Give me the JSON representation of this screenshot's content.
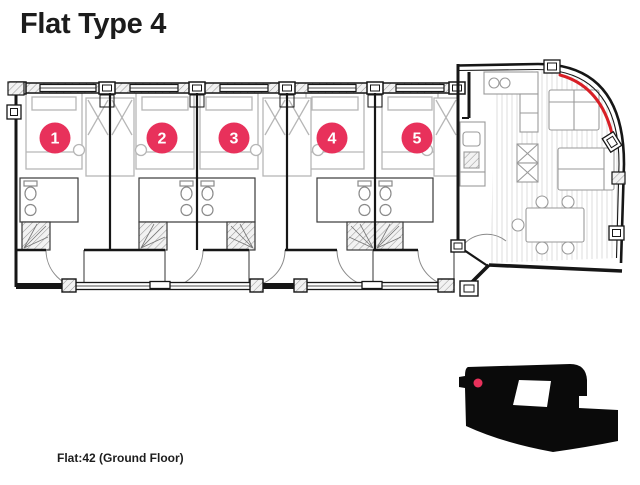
{
  "title": "Flat Type 4",
  "footer_label": "Flat:42 (Ground Floor)",
  "badges": [
    "1",
    "2",
    "3",
    "4",
    "5"
  ],
  "colors": {
    "badge_pink": "#E8315B",
    "accent_red": "#D81F26",
    "wall_black": "#161616",
    "keyplan_black": "#0A0A0A"
  }
}
